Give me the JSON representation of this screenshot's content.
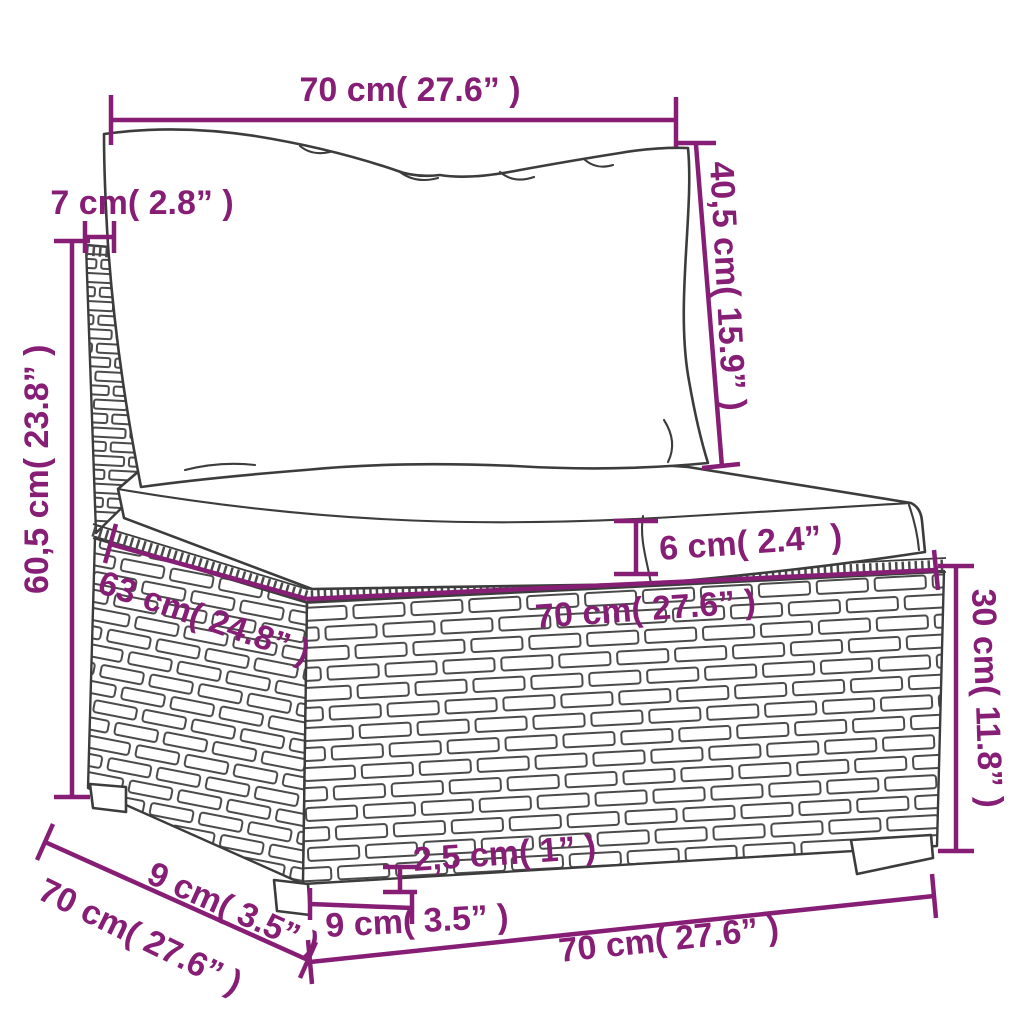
{
  "colors": {
    "dimension": "#871e75",
    "drawing": "#3c3c3c",
    "wicker": "#4a4a4a",
    "background": "#ffffff"
  },
  "labels": {
    "back_width_top": "70 cm( 27.6” )",
    "panel_thickness": "7 cm( 2.8” )",
    "back_cushion_height": "40,5 cm( 15.9” )",
    "total_height": "60,5 cm( 23.8” )",
    "cushion_thickness": "6 cm( 2.4” )",
    "seat_depth": "63 cm( 24.8” )",
    "seat_width": "70 cm( 27.6” )",
    "base_height": "30 cm( 11.8” )",
    "side_foot_span": "9 cm( 3.5” )",
    "base_depth_bottom": "70 cm( 27.6” )",
    "foot_height": "2,5 cm( 1” )",
    "foot_width": "9 cm( 3.5” )",
    "base_width_bottom": "70 cm( 27.6” )"
  }
}
